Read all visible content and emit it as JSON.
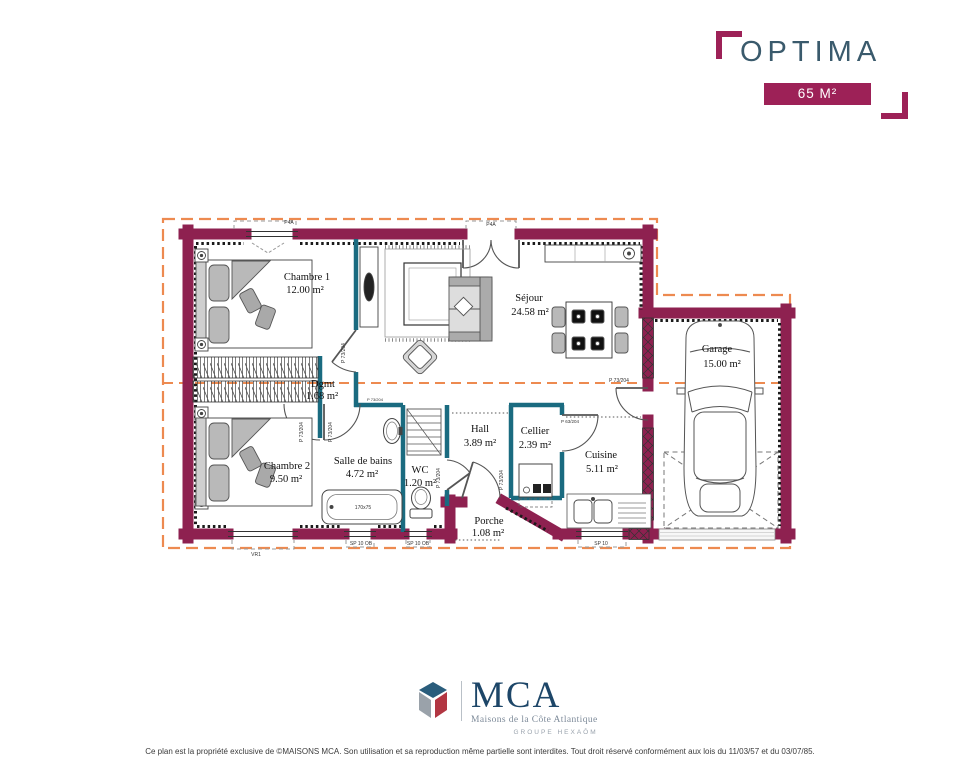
{
  "header": {
    "title": "OPTIMA",
    "area_badge": "65 M²"
  },
  "colors": {
    "maroon": "#9D2157",
    "wall_maroon": "#8E2150",
    "teal": "#1A6B80",
    "roof_orange": "#ED8A50",
    "title_slate": "#3A5A6C",
    "logo_blue": "#1D4668"
  },
  "plan": {
    "rooms": [
      {
        "name": "Chambre 1",
        "area": "12.00 m²"
      },
      {
        "name": "Séjour",
        "area": "24.58 m²"
      },
      {
        "name": "Garage",
        "area": "15.00 m²"
      },
      {
        "name": "Dgmt",
        "area": "1.68 m²"
      },
      {
        "name": "Chambre 2",
        "area": "9.50 m²"
      },
      {
        "name": "Salle de bains",
        "area": "4.72 m²"
      },
      {
        "name": "WC",
        "area": "1.20 m²"
      },
      {
        "name": "Hall",
        "area": "3.89 m²"
      },
      {
        "name": "Cellier",
        "area": "2.39 m²"
      },
      {
        "name": "Cuisine",
        "area": "5.11 m²"
      },
      {
        "name": "Porche",
        "area": "1.08 m²"
      }
    ],
    "annotations": {
      "win_code_1": "P4A",
      "win_code_2": "P4A",
      "door_73": "P 73/204",
      "door_63": "P 63/204",
      "tub_size": "170x75",
      "shutter": "VR1",
      "sill_ob_1": "SP 10 OB",
      "sill_ob_2": "SP 10 OB",
      "sill_3": "SP 10"
    }
  },
  "logo": {
    "acronym": "MCA",
    "name": "Maisons de la Côte Atlantique",
    "group": "GROUPE HEXAÔM"
  },
  "footer": {
    "text": "Ce plan est la propriété exclusive de ©MAISONS MCA. Son utilisation et sa reproduction même partielle sont interdites. Tout droit réservé conformément aux lois du 11/03/57 et du 03/07/85."
  }
}
